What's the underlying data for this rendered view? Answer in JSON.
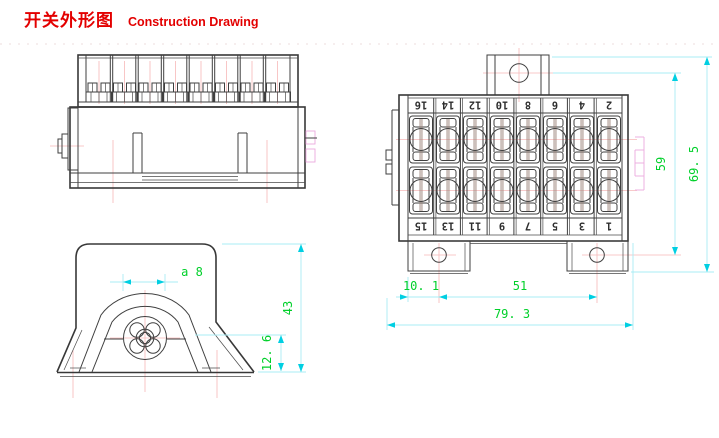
{
  "title": {
    "zh": "开关外形图",
    "en": "Construction Drawing"
  },
  "colors": {
    "title_red": "#e30000",
    "dimension_text_green": "#00d02a",
    "dimension_line_cyan": "#a9ecf4",
    "arrow_cyan": "#00cfe2",
    "centerline_pink": "#f6b8b8",
    "hidden_line_magenta": "#ecaade",
    "drawing_line": "#3f3f3f"
  },
  "top_view": {
    "top_row_numbers": [
      "16",
      "14",
      "12",
      "10",
      "8",
      "6",
      "4",
      "2"
    ],
    "bottom_row_numbers": [
      "15",
      "13",
      "11",
      "9",
      "7",
      "5",
      "3",
      "1"
    ],
    "dim_hole_to_hole_height": "59",
    "dim_overall_height": "69. 5",
    "dim_hole_offset": "10. 1",
    "dim_hole_spacing": "51",
    "dim_overall_width": "79. 3"
  },
  "end_view": {
    "dim_screw": "a 8",
    "dim_overall_height": "43",
    "dim_foot_height": "12. 6"
  }
}
